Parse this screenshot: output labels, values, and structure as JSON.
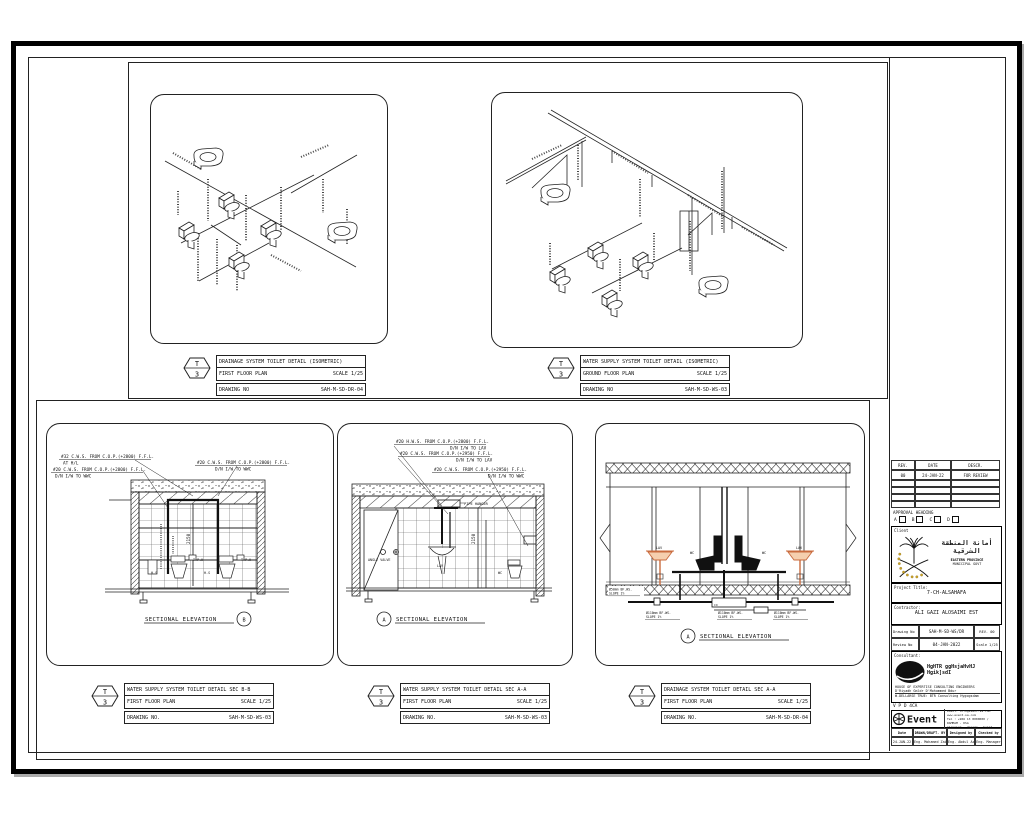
{
  "hex": {
    "top": "T",
    "bottom": "3"
  },
  "title_blocks": [
    {
      "title": "DRAINAGE SYSTEM TOILET DETAIL (ISOMETRIC)",
      "floor": "FIRST FLOOR PLAN",
      "scale": "SCALE 1/25",
      "no_label": "DRAWING NO",
      "number": "SAH-M-SD-DR-04"
    },
    {
      "title": "WATER SUPPLY SYSTEM TOILET DETAIL (ISOMETRIC)",
      "floor": "GROUND FLOOR PLAN",
      "scale": "SCALE 1/25",
      "no_label": "DRAWING NO",
      "number": "SAH-M-SD-WS-03"
    },
    {
      "title": "WATER SUPPLY SYSTEM TOILET DETAIL SEC B-B",
      "floor": "FIRST FLOOR PLAN",
      "scale": "SCALE 1/25",
      "no_label": "DRAWING NO.",
      "number": "SAH-M-SD-WS-03"
    },
    {
      "title": "WATER SUPPLY SYSTEM TOILET DETAIL SEC A-A",
      "floor": "FIRST FLOOR PLAN",
      "scale": "SCALE 1/25",
      "no_label": "DRAWING NO.",
      "number": "SAH-M-SD-WS-03"
    },
    {
      "title": "DRAINAGE SYSTEM TOILET DETAIL SEC A-A",
      "floor": "FIRST FLOOR PLAN",
      "scale": "SCALE 1/25",
      "no_label": "DRAWING NO.",
      "number": "SAH-M-SD-DR-04"
    }
  ],
  "sections": {
    "bb": {
      "ann1_l1": "#32 C.W.S. FROM C.O.P.(+2800) F.F.L.",
      "ann1_l2": "AT H/L",
      "ann2_l1": "#20 C.W.S. FROM C.O.P.(+2800) F.F.L.",
      "ann2_l2": "D/N I/W TO WWC",
      "ann3_l1": "#20 C.W.S. FROM C.O.P.(+2800) F.F.L.",
      "ann3_l2": "D/N I/W TO WWC",
      "tph": "T.P.H",
      "hs": "H.S",
      "dim": "2150",
      "caption": "SECTIONAL ELEVATION",
      "bubble": "B"
    },
    "aa_ws": {
      "ann1_l1": "#20 H.W.S. FROM C.O.P.(+2800) F.F.L.",
      "ann1_l2": "D/N I/W TO LAV",
      "ann2_l1": "#20 C.W.S. FROM C.O.P.(+2950) F.F.L.",
      "ann2_l2": "D/N I/W TO LAV",
      "ann3_l1": "#20 C.W.S. FROM C.O.P.(+2950) F.F.L.",
      "ann3_l2": "D/N I/W TO WWC",
      "pipe_hanger": "PIPE HANGER",
      "angle_valve": "ANGLE VALVE",
      "lav": "LAV",
      "wc": "WC",
      "dim": "2150",
      "caption": "SECTIONAL ELEVATION",
      "bubble": "A"
    },
    "aa_dr": {
      "lav": "LAV",
      "wc": "WC",
      "co": "CO",
      "pipe0_l1": "Ø50mm BF.WS.",
      "pipe0_l2": "SLOPE 1%",
      "pipe1_l1": "Ø110mm BF.WS.",
      "pipe1_l2": "SLOPE 1%",
      "pipe2_l1": "Ø110mm BF.WS.",
      "pipe2_l2": "SLOPE 1%",
      "pipe3_l1": "Ø110mm BF.WS.",
      "pipe3_l2": "SLOPE 1%",
      "caption": "SECTIONAL ELEVATION",
      "bubble": "A"
    }
  },
  "panel": {
    "rev": {
      "h1": "REV.",
      "h2": "DATE",
      "h3": "DESCR.",
      "r1c1": "00",
      "r1c2": "24-JAN-22",
      "r1c3": "FOR REVIEW"
    },
    "approval": {
      "label": "APPROVAL HEADING",
      "a": "A",
      "b": "B",
      "c": "C",
      "d": "D"
    },
    "client": {
      "label": "Client",
      "name_ar": "أمانة المنطقة الشرقية",
      "line1": "EASTERN PROVINCE",
      "line2": "MUNICIPAL GOVT"
    },
    "project": {
      "label": "Project Title:",
      "value": "7-CH-ALSAHAFA"
    },
    "contractor": {
      "label": "Contractor:",
      "value": "ALI GAZI ALOSAIMI EST"
    },
    "meta": {
      "r1l": "Drawing No",
      "r1v": "SAH-M-SD-WS/DR",
      "r1x": "REV. 00",
      "r2l": "Review No",
      "r2v": "04-JAN-2022",
      "r2x": "Scale 1/25"
    },
    "consultant": {
      "label": "Consultant:",
      "logo": "HCE",
      "name": "HgHTR ggHsjaHvHJ Hgik]sdI",
      "line1": "HOUSE OF EXPERTISE CONSULTING ENGINEERS",
      "line2": "D'Riyadh Gmldr    D'Mohammed Bdur",
      "line3": "W.DELLARSE    TRUE: BTR Consulting Hygogsdam"
    },
    "vendor": {
      "label": "V P D 4CA",
      "logo": "Event",
      "tagline": "planning . design . build",
      "contact1": "Email: info@event-sa.com  www.event-sa.com",
      "contact2": "Tel : +966 13 8000000 / DAMMAM - KSA"
    },
    "staff": {
      "h1": "Date",
      "h2": "DRAWN/DRAFT. BY",
      "h3": "Designed by",
      "h4": "Checked by",
      "v1": "24-JAN-22",
      "v2": "Eng. Mohamed Zain",
      "v3": "Eng. Abdul Aziz",
      "v4": "Eng. Manager"
    }
  }
}
